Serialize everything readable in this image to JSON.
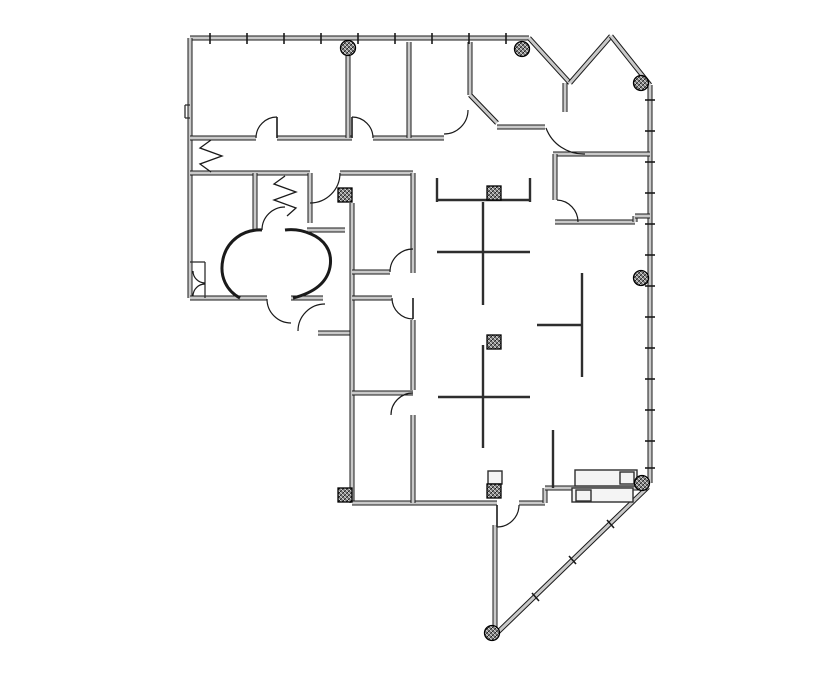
{
  "page": {
    "background": "#ffffff"
  },
  "plan": {
    "canvas": {
      "width": 835,
      "height": 678
    },
    "colors": {
      "line": "#1a1a1a",
      "wall_core": "#c9c9c9",
      "partition": "#2e2e2e",
      "hatch_dark": "#2e2e2e",
      "fixture_fill": "#f4f4f4",
      "column_edge": "#000000"
    },
    "walls_thick": [
      [
        190,
        38,
        529,
        38
      ],
      [
        529,
        38,
        570,
        83
      ],
      [
        570,
        83,
        611,
        36
      ],
      [
        611,
        36,
        650,
        85
      ],
      [
        650,
        85,
        650,
        483
      ],
      [
        648,
        487,
        497,
        633
      ],
      [
        190,
        38,
        190,
        298
      ],
      [
        190,
        298,
        267,
        298
      ],
      [
        291,
        298,
        323,
        298
      ],
      [
        318,
        333,
        352,
        333
      ],
      [
        352,
        203,
        352,
        503
      ],
      [
        352,
        503,
        497,
        503
      ],
      [
        519,
        503,
        545,
        503
      ],
      [
        545,
        503,
        545,
        488
      ],
      [
        545,
        488,
        648,
        488
      ],
      [
        495,
        525,
        495,
        630
      ],
      [
        190,
        138,
        256,
        138
      ],
      [
        277,
        138,
        352,
        138
      ],
      [
        373,
        138,
        444,
        138
      ],
      [
        348,
        55,
        348,
        138
      ],
      [
        409,
        42,
        409,
        138
      ],
      [
        470,
        42,
        470,
        95
      ],
      [
        470,
        95,
        497,
        123
      ],
      [
        497,
        127,
        545,
        127
      ],
      [
        565,
        83,
        565,
        112
      ],
      [
        553,
        154,
        650,
        154
      ],
      [
        555,
        154,
        555,
        200
      ],
      [
        555,
        222,
        635,
        222
      ],
      [
        635,
        222,
        635,
        216
      ],
      [
        635,
        216,
        650,
        216
      ],
      [
        190,
        173,
        310,
        173
      ],
      [
        340,
        173,
        413,
        173
      ],
      [
        255,
        173,
        255,
        230
      ],
      [
        310,
        173,
        310,
        223
      ],
      [
        307,
        230,
        345,
        230
      ],
      [
        413,
        173,
        413,
        273
      ],
      [
        352,
        272,
        390,
        272
      ],
      [
        352,
        298,
        392,
        298
      ],
      [
        413,
        320,
        413,
        390
      ],
      [
        352,
        393,
        413,
        393
      ],
      [
        413,
        415,
        413,
        503
      ]
    ],
    "partitions": [
      [
        437,
        178,
        437,
        202
      ],
      [
        437,
        200,
        530,
        200
      ],
      [
        530,
        178,
        530,
        202
      ],
      [
        483,
        202,
        483,
        305
      ],
      [
        437,
        252,
        530,
        252
      ],
      [
        483,
        345,
        483,
        448
      ],
      [
        438,
        397,
        530,
        397
      ],
      [
        582,
        273,
        582,
        377
      ],
      [
        537,
        325,
        582,
        325
      ],
      [
        553,
        430,
        553,
        488
      ]
    ],
    "thin_lines": [
      [
        190,
        262,
        205,
        262
      ],
      [
        205,
        262,
        205,
        298
      ],
      [
        185,
        105,
        190,
        105
      ],
      [
        185,
        105,
        185,
        118
      ],
      [
        185,
        118,
        190,
        118
      ]
    ],
    "window_ticks": [
      [
        210,
        33,
        210,
        44
      ],
      [
        247,
        33,
        247,
        44
      ],
      [
        284,
        33,
        284,
        44
      ],
      [
        321,
        33,
        321,
        44
      ],
      [
        358,
        33,
        358,
        44
      ],
      [
        395,
        33,
        395,
        44
      ],
      [
        432,
        33,
        432,
        44
      ],
      [
        469,
        33,
        469,
        44
      ],
      [
        506,
        33,
        506,
        44
      ],
      [
        645,
        100,
        655,
        100
      ],
      [
        645,
        131,
        655,
        131
      ],
      [
        645,
        162,
        655,
        162
      ],
      [
        645,
        193,
        655,
        193
      ],
      [
        645,
        224,
        655,
        224
      ],
      [
        645,
        255,
        655,
        255
      ],
      [
        645,
        286,
        655,
        286
      ],
      [
        645,
        317,
        655,
        317
      ],
      [
        645,
        348,
        655,
        348
      ],
      [
        645,
        379,
        655,
        379
      ],
      [
        645,
        410,
        655,
        410
      ],
      [
        645,
        441,
        655,
        441
      ],
      [
        645,
        468,
        655,
        468
      ],
      [
        607,
        520,
        614,
        528
      ],
      [
        569,
        556,
        576,
        564
      ],
      [
        532,
        593,
        539,
        601
      ]
    ],
    "door_arcs": [
      "M 256 138 A 21 21 0 0 1 277 117",
      "M 373 138 A 21 21 0 0 0 352 117",
      "M 468 110 A 24 24 0 0 1 444 134",
      "M 546 128 A 40 40 0 0 0 585 154",
      "M 557 200 A 22 22 0 0 1 578 222",
      "M 340 173 A 30 30 0 0 1 310 203",
      "M 390 272 A 23 23 0 0 1 413 249",
      "M 262 230 A 23 23 0 0 1 285 207",
      "M 267 299 A 24 24 0 0 0 291 323",
      "M 298 331 A 27 27 0 0 1 325 304",
      "M 392 298 A 21 21 0 0 0 413 319",
      "M 391 415 A 22 22 0 0 1 413 393",
      "M 519 505 A 22 22 0 0 1 497 527",
      "M 193 271 A 12 12 0 0 0 205 283",
      "M 193 296 A 12 12 0 0 1 205 284"
    ],
    "door_leaves": [
      [
        277,
        117,
        277,
        138
      ],
      [
        352,
        117,
        352,
        138
      ],
      [
        413,
        298,
        413,
        319
      ],
      [
        497,
        505,
        497,
        527
      ]
    ],
    "folding_doors": [
      "211,140 200,148 222,156 200,164 211,172",
      "285,176 274,184 296,192 274,200 296,208 287,216"
    ],
    "curved_walls": [
      "M 262 230 C 243 229 227 241 223 259 C 219 277 227 291 240 298",
      "M 293 298 C 313 293 327 283 330 267 C 333 250 323 239 311 234 C 302 230 293 229 285 230"
    ],
    "columns_square": [
      [
        338,
        188
      ],
      [
        487,
        186
      ],
      [
        487,
        335
      ],
      [
        338,
        488
      ],
      [
        487,
        484
      ]
    ],
    "columns_round": [
      [
        348,
        48
      ],
      [
        522,
        49
      ],
      [
        641,
        83
      ],
      [
        641,
        278
      ],
      [
        642,
        483
      ],
      [
        492,
        633
      ]
    ],
    "fixtures": [
      [
        575,
        470,
        62,
        16
      ],
      [
        620,
        472,
        14,
        12
      ],
      [
        572,
        488,
        61,
        14
      ],
      [
        576,
        490,
        15,
        11
      ],
      [
        488,
        471,
        14,
        13
      ]
    ]
  }
}
